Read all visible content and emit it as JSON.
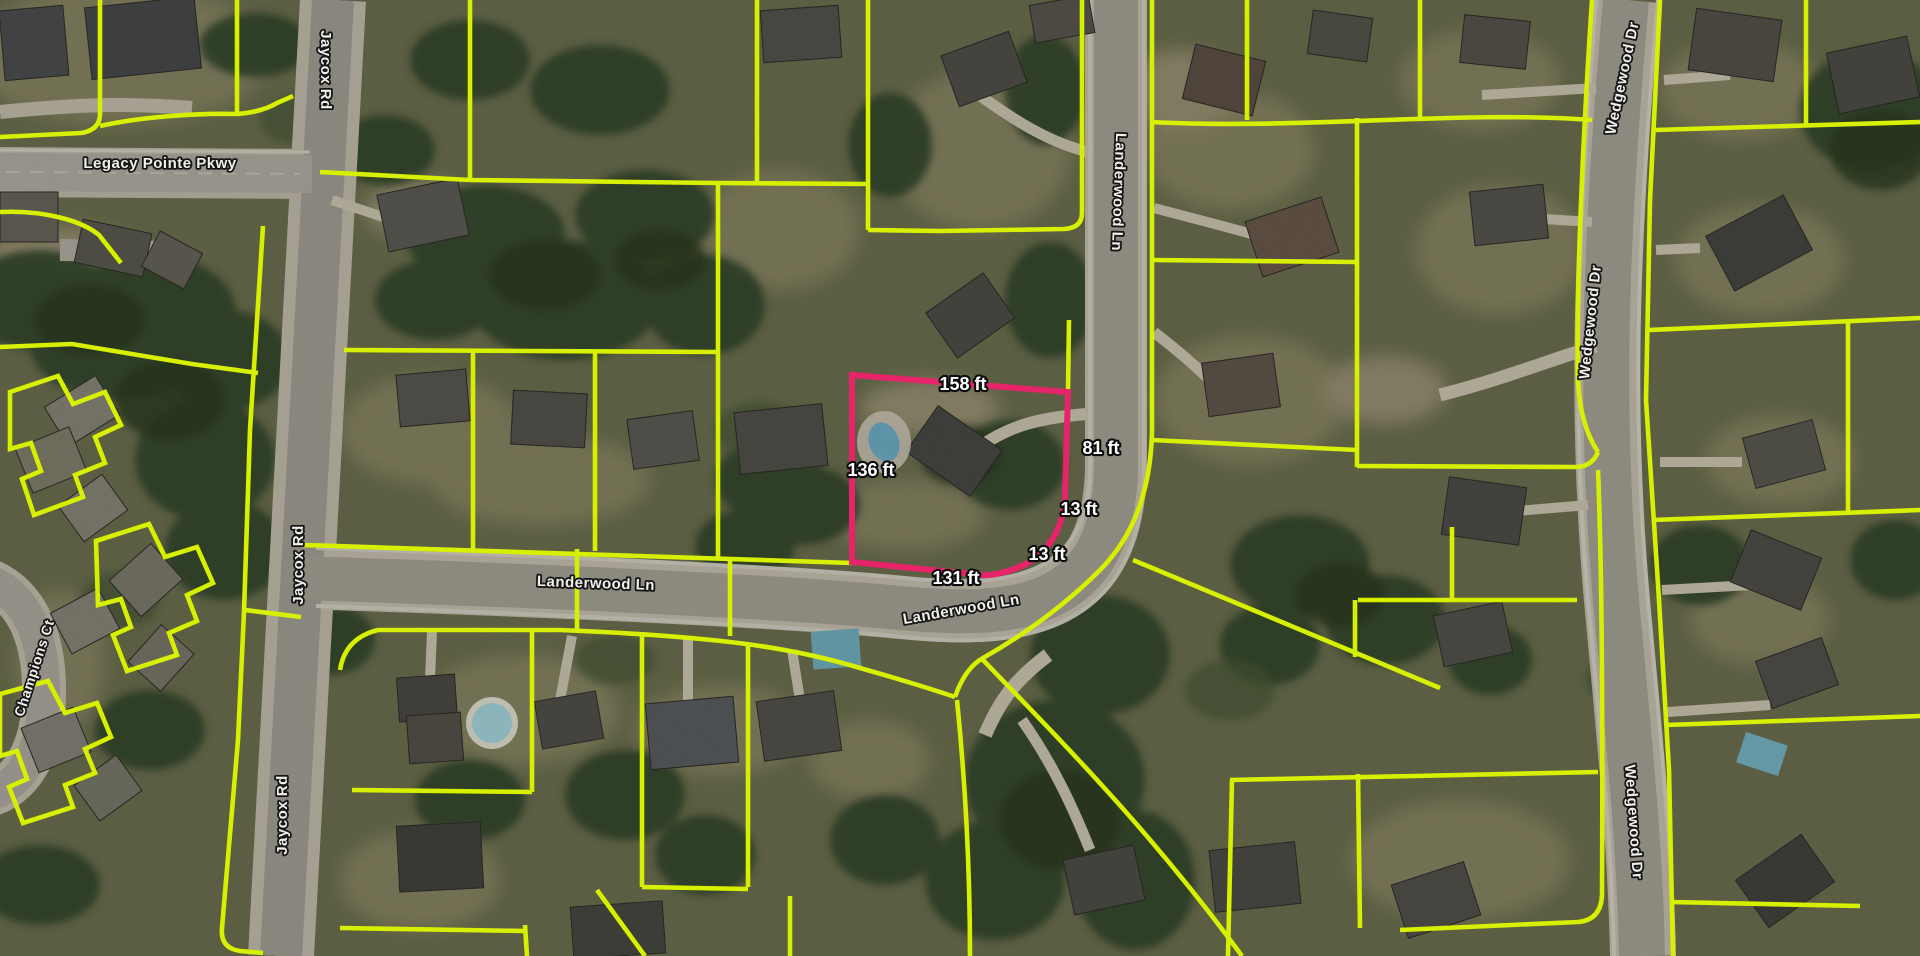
{
  "map": {
    "street_labels": [
      {
        "id": "legacy-pointe-pkwy",
        "text": "Legacy Pointe Pkwy"
      },
      {
        "id": "jaycox-rd-top",
        "text": "Jaycox Rd"
      },
      {
        "id": "jaycox-rd-middle",
        "text": "Jaycox Rd"
      },
      {
        "id": "jaycox-rd-bottom",
        "text": "Jaycox Rd"
      },
      {
        "id": "landerwood-ln-vertical",
        "text": "Landerwood Ln"
      },
      {
        "id": "landerwood-ln-west",
        "text": "Landerwood Ln"
      },
      {
        "id": "landerwood-ln-curve",
        "text": "Landerwood Ln"
      },
      {
        "id": "wedgewood-dr-top",
        "text": "Wedgewood Dr"
      },
      {
        "id": "wedgewood-dr-middle",
        "text": "Wedgewood Dr"
      },
      {
        "id": "wedgewood-dr-bottom",
        "text": "Wedgewood Dr"
      },
      {
        "id": "champions-ct",
        "text": "Champions Ct"
      }
    ],
    "highlighted_parcel": {
      "dimension_labels": [
        {
          "id": "dim-top",
          "text": "158 ft"
        },
        {
          "id": "dim-right",
          "text": "81 ft"
        },
        {
          "id": "dim-corner-upper",
          "text": "13 ft"
        },
        {
          "id": "dim-corner-lower",
          "text": "13 ft"
        },
        {
          "id": "dim-bottom",
          "text": "131 ft"
        },
        {
          "id": "dim-left",
          "text": "136 ft"
        }
      ]
    },
    "colors": {
      "parcel_line": "#d7f000",
      "highlight_outline": "#e6246a",
      "street_label": "#f0efe9",
      "dimension_label": "#ffffff"
    }
  }
}
